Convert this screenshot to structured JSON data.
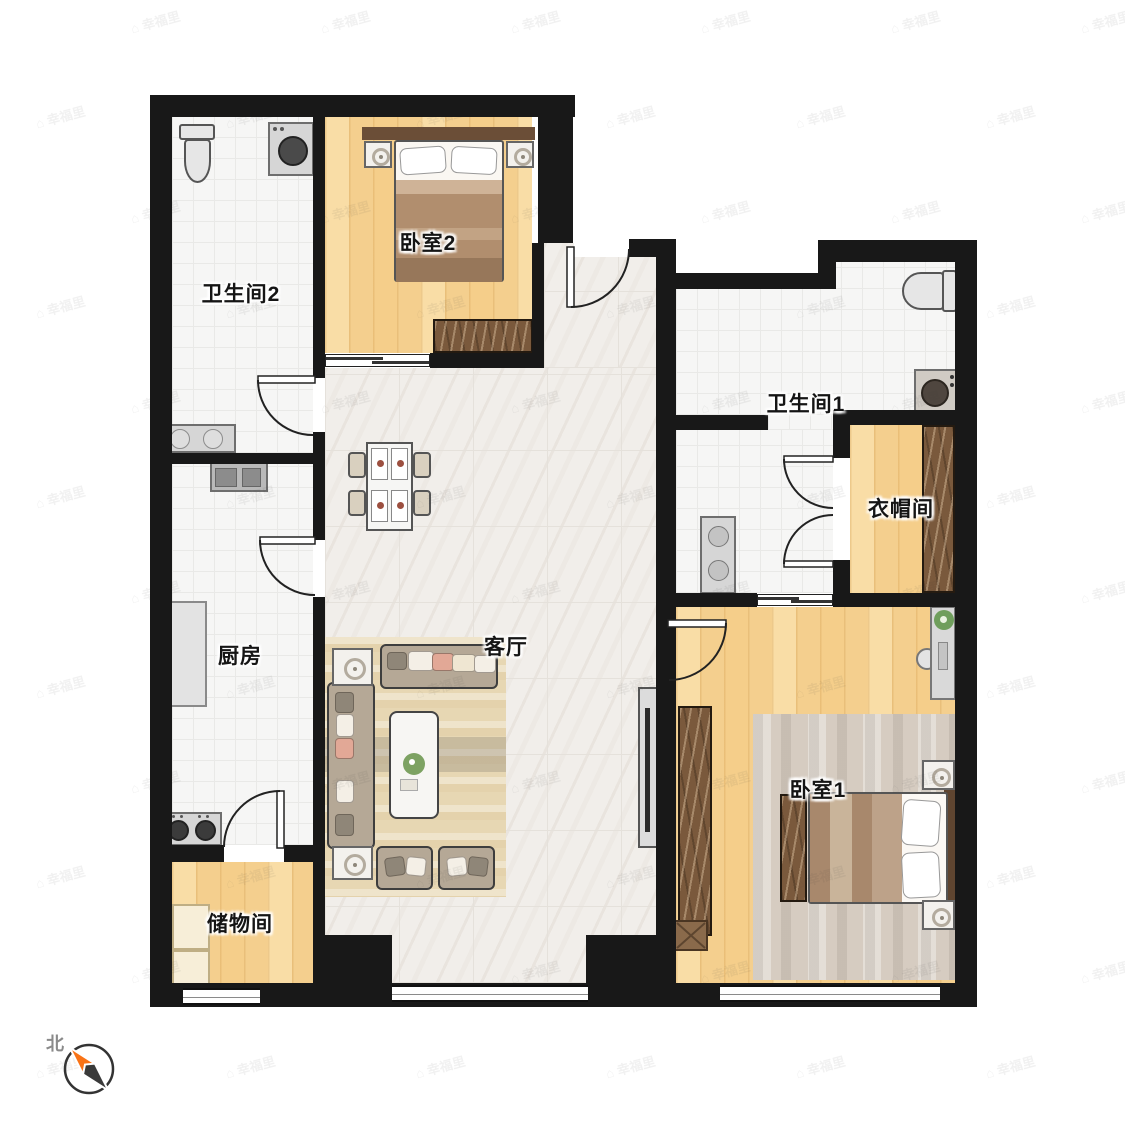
{
  "rooms": {
    "bathroom2": {
      "label": "卫生间2"
    },
    "bedroom2": {
      "label": "卧室2"
    },
    "bathroom1": {
      "label": "卫生间1"
    },
    "closet": {
      "label": "衣帽间"
    },
    "kitchen": {
      "label": "厨房"
    },
    "living": {
      "label": "客厅"
    },
    "bedroom1": {
      "label": "卧室1"
    },
    "storage": {
      "label": "储物间"
    }
  },
  "compass": {
    "label": "北",
    "needle_color": "#f97316",
    "needle_dark": "#3a3a3a"
  },
  "watermark": {
    "icon": "⌂",
    "text": "幸福里",
    "color": "rgba(60,60,60,0.07)"
  },
  "colors": {
    "wall": "#181818",
    "wood_floor": "#f4cf8e",
    "marble_floor": "#f1eeea",
    "tile_floor": "#f6f6f5",
    "wardrobe": "#7a593c",
    "rug_living": "#e7d7b3",
    "rug_bedroom1": "#d6ccc1"
  }
}
